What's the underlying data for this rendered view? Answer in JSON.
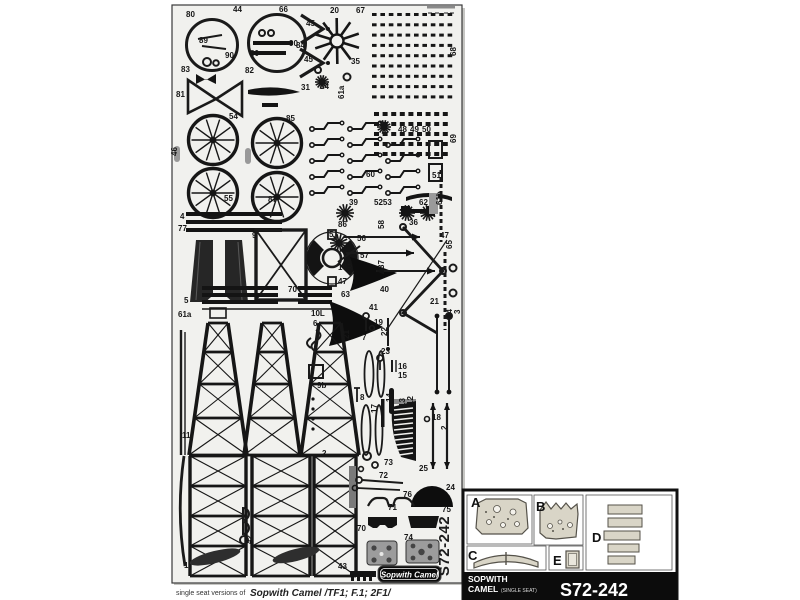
{
  "sheet": {
    "background": "#f1f1ee",
    "part_color": "#161616",
    "code_vertical": "S72-242",
    "badge_label": "Sopwith Camel",
    "labels": [
      {
        "t": "80",
        "x": 186,
        "y": 17
      },
      {
        "t": "44",
        "x": 233,
        "y": 12
      },
      {
        "t": "66",
        "x": 279,
        "y": 12
      },
      {
        "t": "20",
        "x": 330,
        "y": 13
      },
      {
        "t": "67",
        "x": 356,
        "y": 13
      },
      {
        "t": "45",
        "x": 306,
        "y": 26
      },
      {
        "t": "45",
        "x": 304,
        "y": 62
      },
      {
        "t": "84",
        "x": 296,
        "y": 48
      },
      {
        "t": "35",
        "x": 351,
        "y": 64
      },
      {
        "t": "89",
        "x": 199,
        "y": 43
      },
      {
        "t": "90",
        "x": 225,
        "y": 58
      },
      {
        "t": "80",
        "x": 250,
        "y": 56
      },
      {
        "t": "90",
        "x": 289,
        "y": 46
      },
      {
        "t": "83",
        "x": 181,
        "y": 72
      },
      {
        "t": "82",
        "x": 245,
        "y": 73
      },
      {
        "t": "81",
        "x": 176,
        "y": 97
      },
      {
        "t": "31",
        "x": 301,
        "y": 90
      },
      {
        "t": "34",
        "x": 320,
        "y": 89
      },
      {
        "t": "61a",
        "x": 344,
        "y": 99,
        "r": -90
      },
      {
        "t": "68",
        "x": 456,
        "y": 56,
        "r": -90
      },
      {
        "t": "69",
        "x": 456,
        "y": 143,
        "r": -90
      },
      {
        "t": "65",
        "x": 452,
        "y": 249,
        "r": -90
      },
      {
        "t": "64",
        "x": 452,
        "y": 318,
        "r": -90
      },
      {
        "t": "46",
        "x": 177,
        "y": 156,
        "r": -90
      },
      {
        "t": "54",
        "x": 229,
        "y": 119
      },
      {
        "t": "85",
        "x": 286,
        "y": 121
      },
      {
        "t": "55",
        "x": 224,
        "y": 201
      },
      {
        "t": "87",
        "x": 268,
        "y": 202
      },
      {
        "t": "48",
        "x": 398,
        "y": 132
      },
      {
        "t": "49",
        "x": 410,
        "y": 132
      },
      {
        "t": "50",
        "x": 422,
        "y": 132
      },
      {
        "t": "60",
        "x": 366,
        "y": 177
      },
      {
        "t": "51",
        "x": 432,
        "y": 178
      },
      {
        "t": "61b",
        "x": 442,
        "y": 205,
        "r": -90
      },
      {
        "t": "39",
        "x": 349,
        "y": 205
      },
      {
        "t": "5253",
        "x": 374,
        "y": 205
      },
      {
        "t": "62",
        "x": 419,
        "y": 205
      },
      {
        "t": "86",
        "x": 338,
        "y": 227
      },
      {
        "t": "36",
        "x": 409,
        "y": 225
      },
      {
        "t": "47",
        "x": 440,
        "y": 238
      },
      {
        "t": "58",
        "x": 384,
        "y": 229,
        "r": -90
      },
      {
        "t": "56",
        "x": 357,
        "y": 241
      },
      {
        "t": "57",
        "x": 360,
        "y": 258
      },
      {
        "t": "4",
        "x": 180,
        "y": 219
      },
      {
        "t": "77",
        "x": 178,
        "y": 231
      },
      {
        "t": "9",
        "x": 252,
        "y": 238
      },
      {
        "t": "5",
        "x": 329,
        "y": 237
      },
      {
        "t": "10R",
        "x": 338,
        "y": 270
      },
      {
        "t": "47",
        "x": 338,
        "y": 284
      },
      {
        "t": "63",
        "x": 341,
        "y": 297
      },
      {
        "t": "37",
        "x": 384,
        "y": 269,
        "r": -90
      },
      {
        "t": "40",
        "x": 380,
        "y": 292
      },
      {
        "t": "21",
        "x": 430,
        "y": 304
      },
      {
        "t": "70",
        "x": 288,
        "y": 292
      },
      {
        "t": "5",
        "x": 184,
        "y": 303
      },
      {
        "t": "61a",
        "x": 178,
        "y": 317
      },
      {
        "t": "10L",
        "x": 311,
        "y": 316
      },
      {
        "t": "6",
        "x": 313,
        "y": 326
      },
      {
        "t": "41",
        "x": 369,
        "y": 310
      },
      {
        "t": "21",
        "x": 349,
        "y": 339,
        "r": -90
      },
      {
        "t": "7",
        "x": 362,
        "y": 340
      },
      {
        "t": "19",
        "x": 374,
        "y": 325
      },
      {
        "t": "22",
        "x": 387,
        "y": 336,
        "r": -90
      },
      {
        "t": "23",
        "x": 381,
        "y": 354
      },
      {
        "t": "16",
        "x": 398,
        "y": 369
      },
      {
        "t": "15",
        "x": 398,
        "y": 378
      },
      {
        "t": "14",
        "x": 392,
        "y": 402,
        "r": -90
      },
      {
        "t": "17",
        "x": 377,
        "y": 413,
        "r": -90
      },
      {
        "t": "13",
        "x": 405,
        "y": 407,
        "r": -90
      },
      {
        "t": "12",
        "x": 413,
        "y": 405,
        "r": -90
      },
      {
        "t": "8",
        "x": 360,
        "y": 400
      },
      {
        "t": "18",
        "x": 432,
        "y": 420
      },
      {
        "t": "2",
        "x": 322,
        "y": 456
      },
      {
        "t": "3",
        "x": 460,
        "y": 314,
        "r": -90
      },
      {
        "t": "9b",
        "x": 317,
        "y": 388
      },
      {
        "t": "11",
        "x": 182,
        "y": 438
      },
      {
        "t": "25",
        "x": 419,
        "y": 471
      },
      {
        "t": "73",
        "x": 384,
        "y": 465
      },
      {
        "t": "72",
        "x": 379,
        "y": 478
      },
      {
        "t": "76",
        "x": 403,
        "y": 497
      },
      {
        "t": "24",
        "x": 446,
        "y": 490
      },
      {
        "t": "75",
        "x": 442,
        "y": 512
      },
      {
        "t": "71",
        "x": 388,
        "y": 510
      },
      {
        "t": "70",
        "x": 357,
        "y": 531
      },
      {
        "t": "74",
        "x": 404,
        "y": 540
      },
      {
        "t": "42",
        "x": 252,
        "y": 544,
        "r": -90
      },
      {
        "t": "43",
        "x": 338,
        "y": 569
      },
      {
        "t": "1",
        "x": 184,
        "y": 568
      },
      {
        "t": "2",
        "x": 447,
        "y": 430,
        "r": -90
      }
    ]
  },
  "caption": {
    "prefix": "single seat versions of",
    "title": "Sopwith Camel /TF1; F.1; 2F1/"
  },
  "inset": {
    "section_labels": [
      "A",
      "B",
      "C",
      "D",
      "E"
    ],
    "part_fill": "#d9d5c7",
    "part_edge": "#55524a",
    "band": {
      "line1": "SOPWITH",
      "line2": "CAMEL",
      "suffix": "(SINGLE SEAT)",
      "code": "S72-242",
      "bg": "#0c0c0c",
      "fg": "#ffffff"
    }
  }
}
